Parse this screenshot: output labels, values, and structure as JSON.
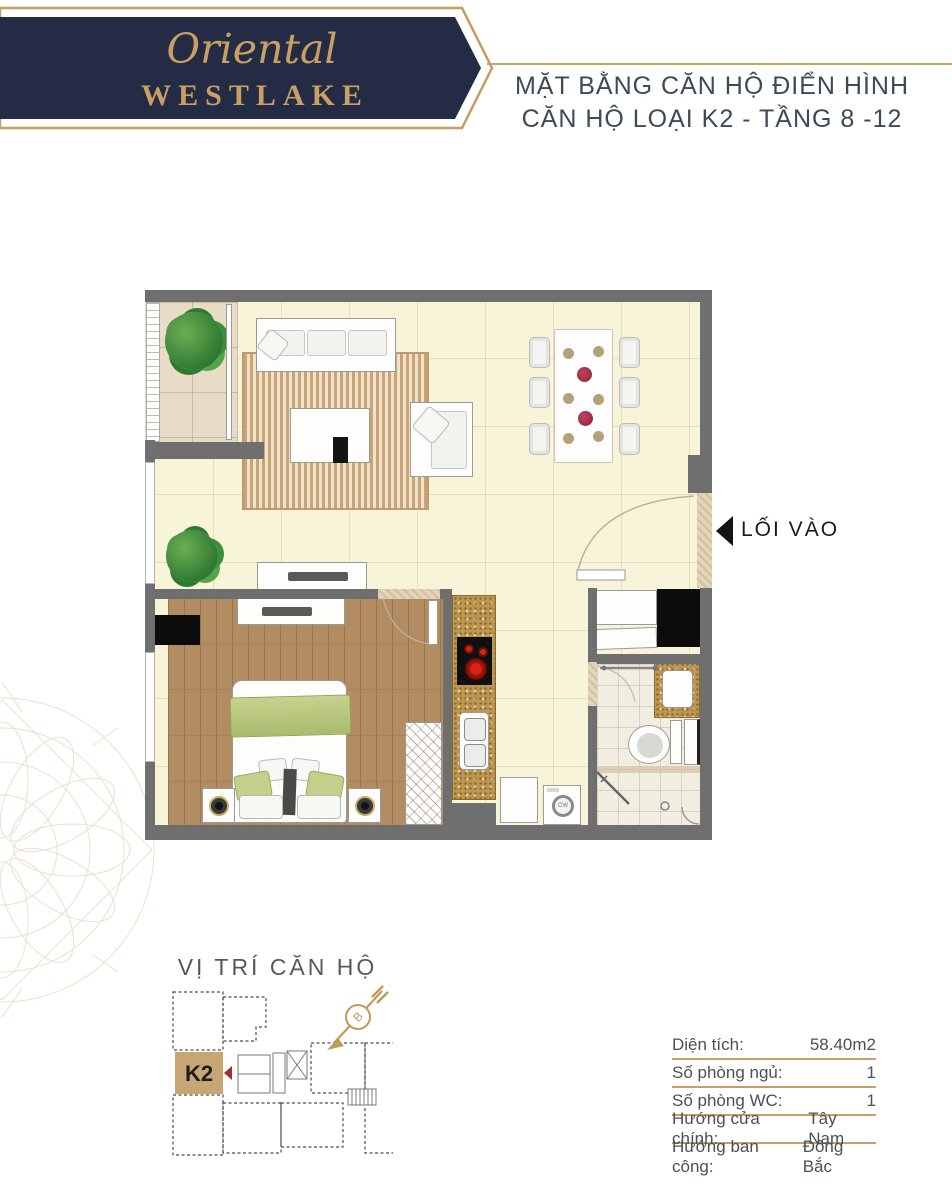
{
  "brand": {
    "script": "Oriental",
    "name": "WESTLAKE"
  },
  "header": {
    "title_line1": "MẶT BẰNG CĂN HỘ ĐIỂN HÌNH",
    "title_line2": "CĂN HỘ LOẠI K2 - TẦNG 8 -12"
  },
  "floorplan": {
    "entrance_label": "LỐI VÀO",
    "washer_label": "CW"
  },
  "location": {
    "title": "VỊ TRÍ CĂN HỘ",
    "unit_label": "K2",
    "compass_letter": "B"
  },
  "details": {
    "rows": [
      {
        "label": "Diện tích:",
        "value": "58.40m2"
      },
      {
        "label": "Số phòng ngủ:",
        "value": "1"
      },
      {
        "label": "Số phòng WC:",
        "value": "1"
      },
      {
        "label": "Hướng cửa chính:",
        "value": "Tây Nam"
      },
      {
        "label": "Hướng ban công:",
        "value": "Đông Bắc"
      }
    ]
  },
  "colors": {
    "brand_navy": "#232b45",
    "gold": "#c49b5e",
    "title_text": "#3e4a55",
    "floor_cream": "#f8f4d9",
    "wall_gray": "#6f6f6f",
    "wood": "#b28d61",
    "rug_stripe": "#cda87e",
    "granite": "#bf9a55",
    "unit_fill": "#c8a674",
    "marker_red": "#a5302a",
    "accent_green": "#bdcb83"
  }
}
